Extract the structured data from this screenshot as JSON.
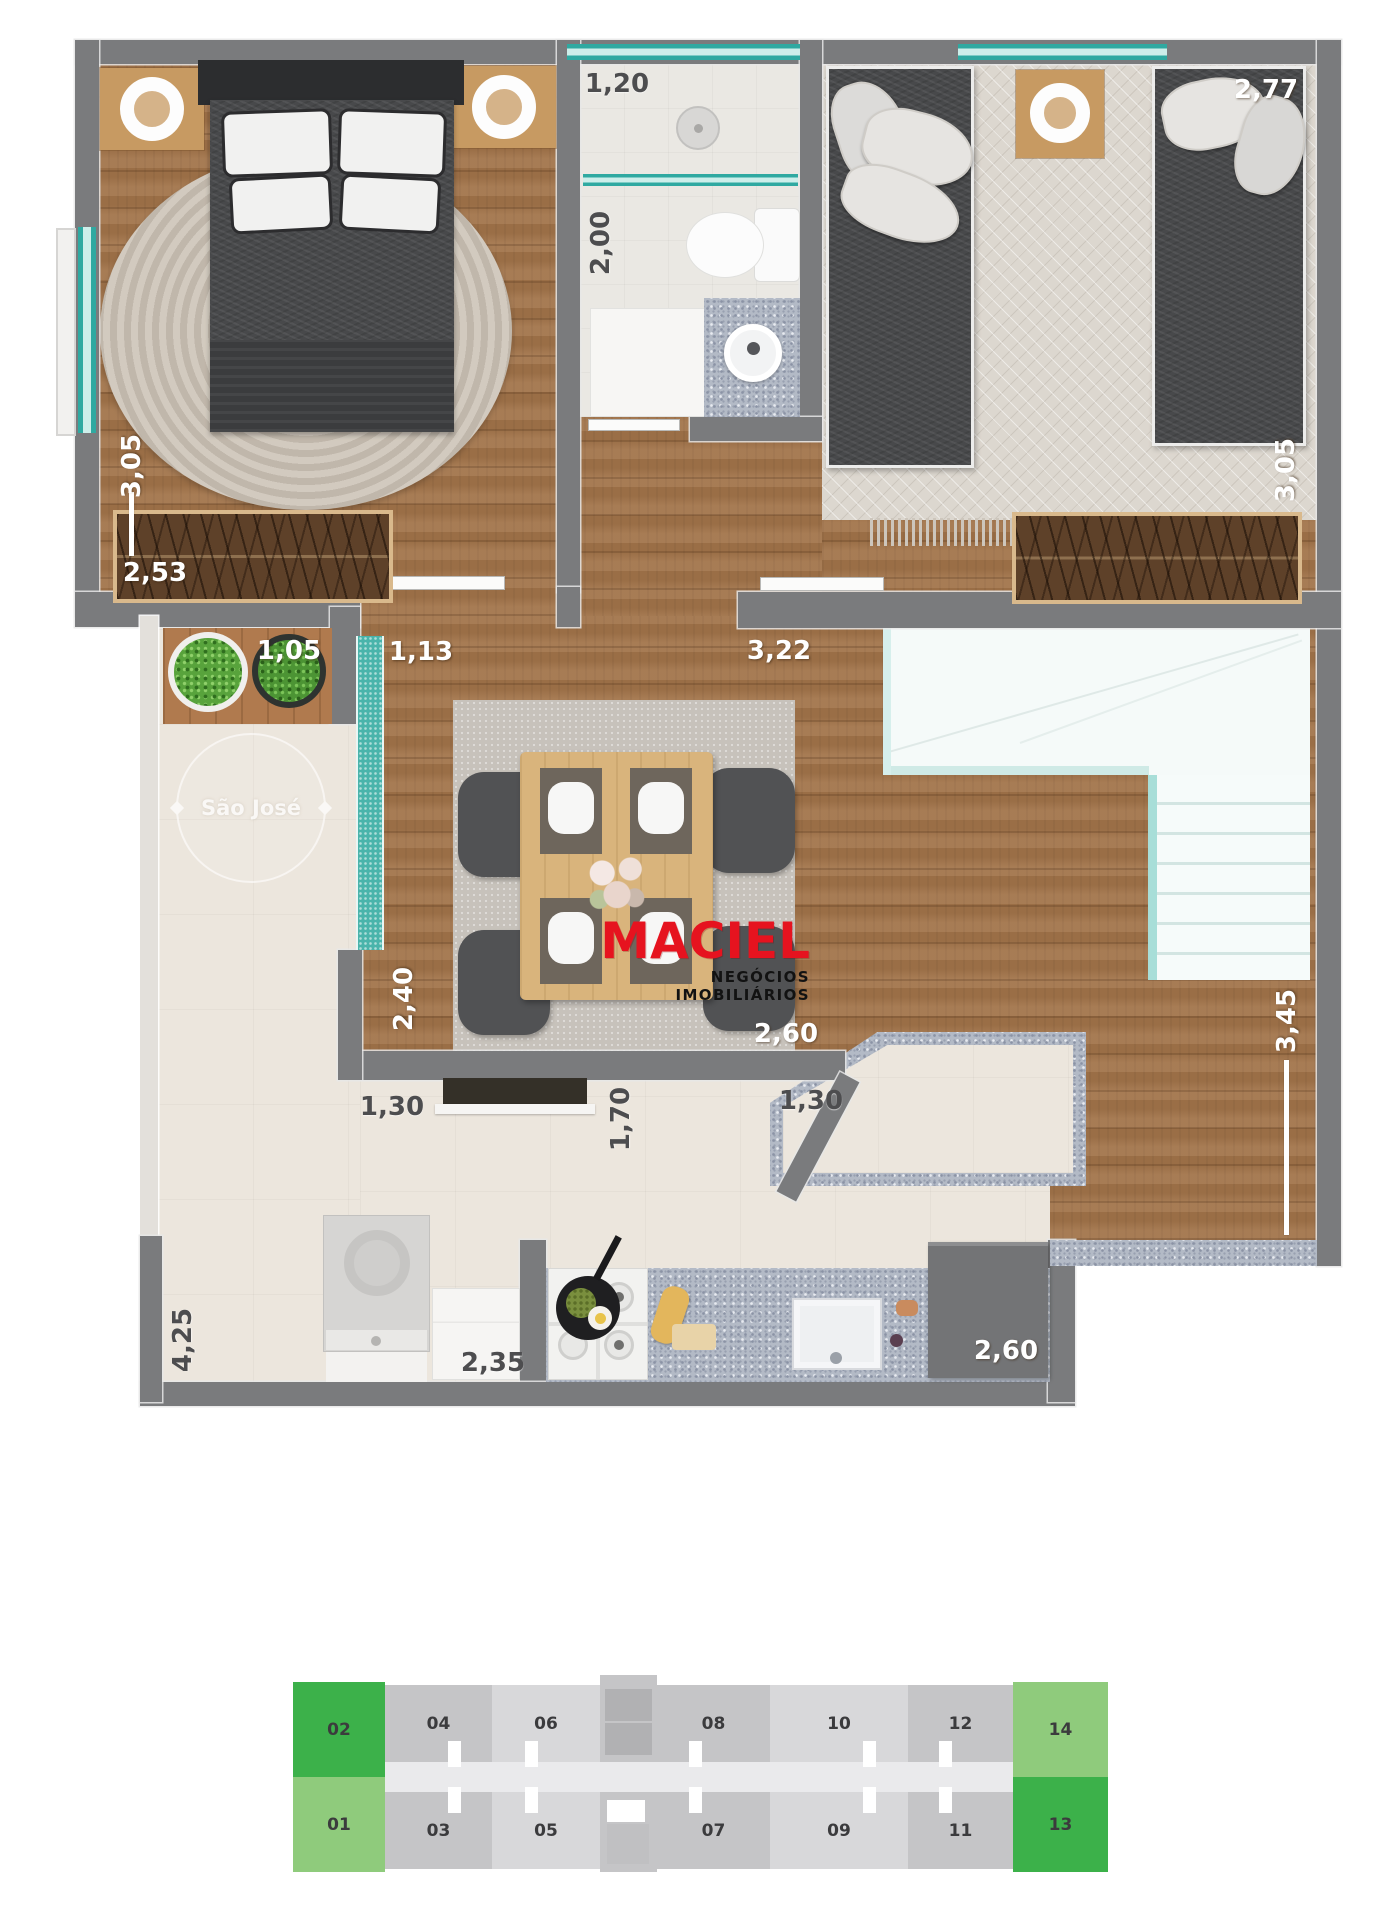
{
  "logo": {
    "brand": "MACIEL",
    "tagline": "NEGÓCIOS IMOBILIÁRIOS",
    "brand_color": "#e6131f"
  },
  "watermark": {
    "name": "São José"
  },
  "dims": {
    "bed1_side": "3,05",
    "bed1_wardrobe": "2,53",
    "bath_w": "1,20",
    "bath_d": "2,00",
    "bed2_w": "2,77",
    "bed2_side": "3,05",
    "terrace_w": "1,05",
    "hall_w": "1,13",
    "hall_wall": "3,22",
    "living_d": "2,40",
    "dining_w": "2,60",
    "pass_left": "1,30",
    "pass_height": "1,70",
    "pass_right": "1,30",
    "stairs_d": "3,45",
    "kitchen_d": "4,25",
    "kitchen_left": "2,35",
    "kitchen_right": "2,60"
  },
  "floor": {
    "top_row": [
      "02",
      "04",
      "06",
      "08",
      "10",
      "12",
      "14"
    ],
    "bottom_row": [
      "01",
      "03",
      "05",
      "07",
      "09",
      "11",
      "13"
    ],
    "highlight_dark_green": "#3cb14a",
    "highlight_light_green": "#8fcb7c"
  }
}
